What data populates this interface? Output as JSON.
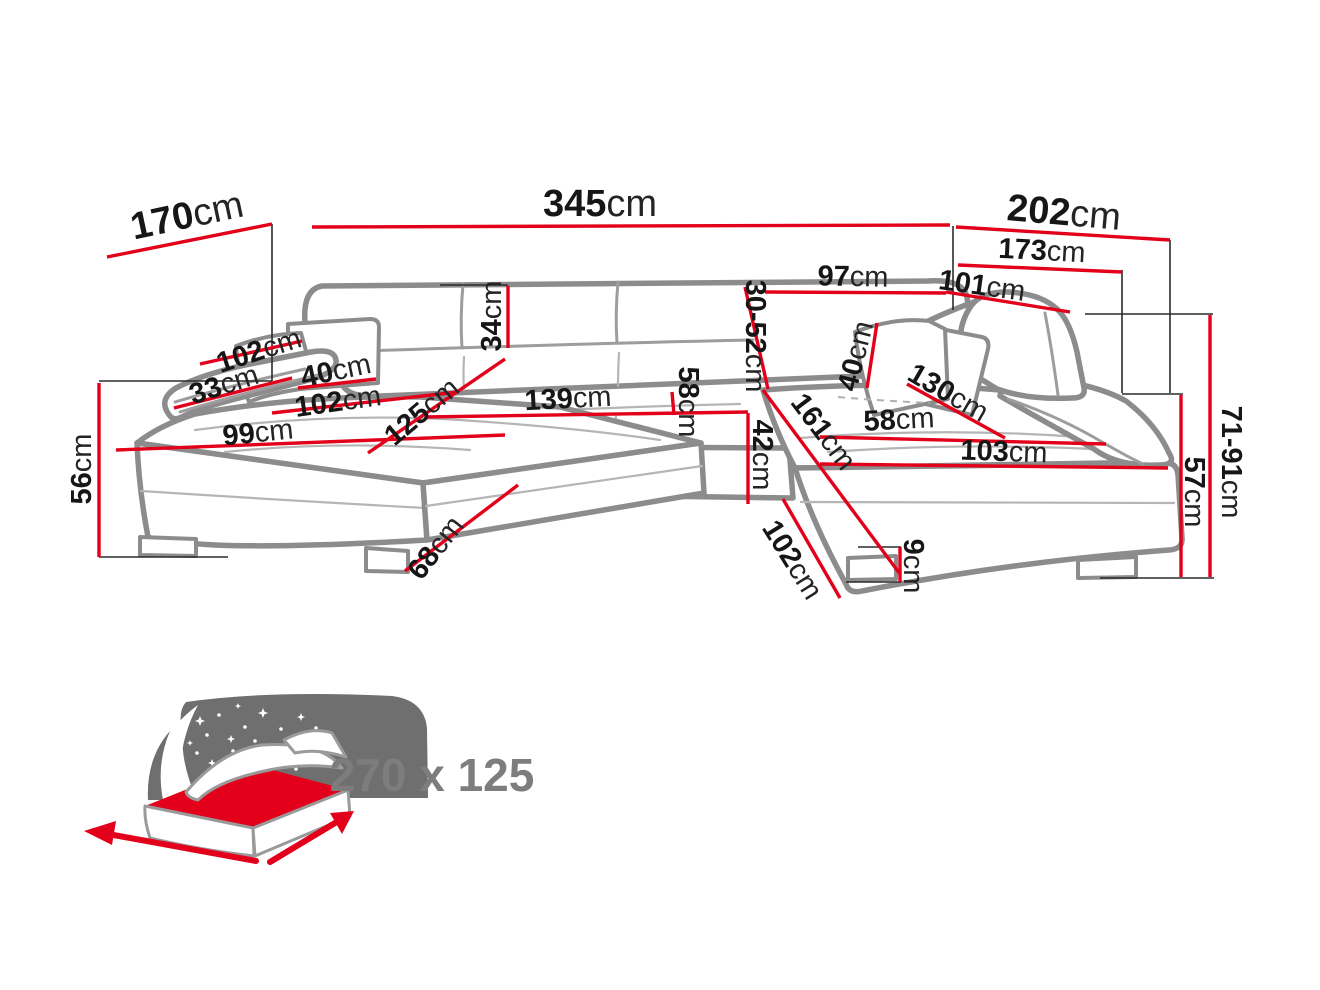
{
  "diagram": {
    "title": "corner-sofa-dimensions",
    "unit": "cm",
    "dimensions": {
      "left_side_depth": {
        "v": "170",
        "u": "cm"
      },
      "total_width": {
        "v": "345",
        "u": "cm"
      },
      "right_side_depth": {
        "v": "202",
        "u": "cm"
      },
      "right_inner_width": {
        "v": "173",
        "u": "cm"
      },
      "back_section_width": {
        "v": "97",
        "u": "cm"
      },
      "right_back_width": {
        "v": "101",
        "u": "cm"
      },
      "backrest_cushion_height": {
        "v": "34",
        "u": "cm"
      },
      "adjustable_backrest_height": {
        "v": "30-52",
        "u": "cm"
      },
      "armrest_length": {
        "v": "102",
        "u": "cm"
      },
      "armrest_height": {
        "v": "33",
        "u": "cm"
      },
      "left_pillow_width": {
        "v": "40",
        "u": "cm"
      },
      "left_seat_depth": {
        "v": "102",
        "u": "cm"
      },
      "chaise_seat_width": {
        "v": "99",
        "u": "cm"
      },
      "chaise_seat_length": {
        "v": "125",
        "u": "cm"
      },
      "middle_seat_width": {
        "v": "139",
        "u": "cm"
      },
      "middle_seat_depth": {
        "v": "58",
        "u": "cm"
      },
      "seat_height_front": {
        "v": "42",
        "u": "cm"
      },
      "right_seat_length": {
        "v": "161",
        "u": "cm"
      },
      "right_seat_depth": {
        "v": "58",
        "u": "cm"
      },
      "right_pillow_width": {
        "v": "40",
        "u": "cm"
      },
      "right_seat_diagonal": {
        "v": "130",
        "u": "cm"
      },
      "right_seat_width": {
        "v": "103",
        "u": "cm"
      },
      "base_side_length": {
        "v": "102",
        "u": "cm"
      },
      "leg_height": {
        "v": "9",
        "u": "cm"
      },
      "chaise_side_depth": {
        "v": "68",
        "u": "cm"
      },
      "side_height": {
        "v": "56",
        "u": "cm"
      },
      "backrest_height_range": {
        "v": "71-91",
        "u": "cm"
      },
      "seat_base_height": {
        "v": "57",
        "u": "cm"
      }
    },
    "sleeping_area": {
      "label": "270 x 125"
    },
    "colors": {
      "dimension_red": "#e2001a",
      "sofa_outline": "#8c8c8c",
      "label_text": "#161616",
      "icon_gray": "#6f6f6f",
      "icon_text": "#7d7d7d"
    }
  }
}
